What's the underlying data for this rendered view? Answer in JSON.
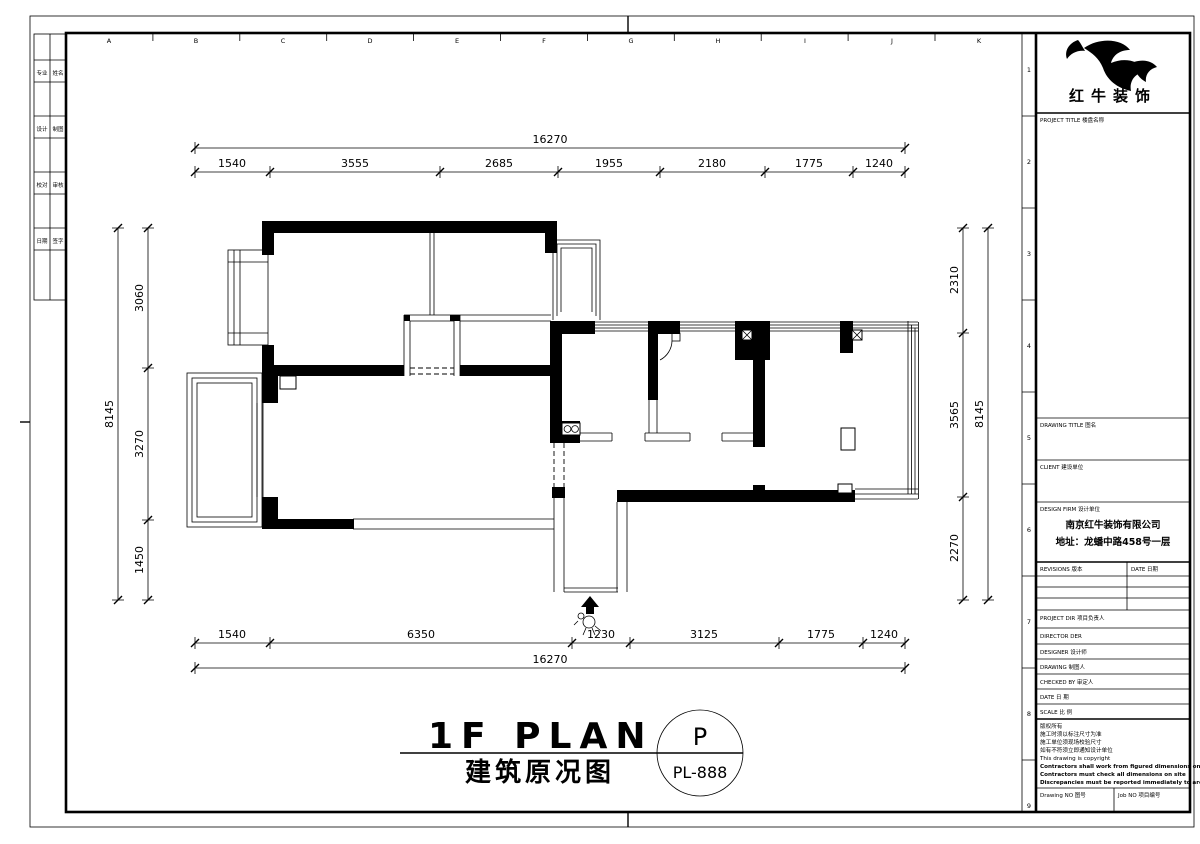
{
  "sheet": {
    "grid_letters": [
      "A",
      "B",
      "C",
      "D",
      "E",
      "F",
      "G",
      "H",
      "I",
      "J",
      "K"
    ],
    "grid_numbers": [
      "1",
      "2",
      "3",
      "4",
      "5",
      "6",
      "7",
      "8",
      "9"
    ],
    "sign_strip": {
      "rows": [
        [
          "专业",
          "姓名"
        ],
        [
          "设计",
          "制图"
        ],
        [
          "校对",
          "审核"
        ],
        [
          "日期",
          "签字"
        ]
      ]
    }
  },
  "plan": {
    "dims_top": {
      "total": "16270",
      "segments": [
        "1540",
        "3555",
        "2685",
        "1955",
        "2180",
        "1775",
        "1240"
      ]
    },
    "dims_bottom": {
      "total": "16270",
      "segments": [
        "1540",
        "6350",
        "1230",
        "3125",
        "1775",
        "1240"
      ]
    },
    "dims_left": {
      "total": "8145",
      "segments": [
        "3060",
        "3270",
        "1450"
      ]
    },
    "dims_right": {
      "total": "8145",
      "segments": [
        "2310",
        "3565",
        "2270"
      ]
    }
  },
  "footer": {
    "main_title": "1F PLAN",
    "sub_title": "建筑原况图",
    "bubble_letter": "P",
    "bubble_code": "PL-888"
  },
  "tb": {
    "brand": "红牛装饰",
    "project_title_label": "PROJECT TITLE  楼盘名称",
    "drawing_title_label": "DRAWING TITLE  图名",
    "client_label": "CLIENT  建设单位",
    "design_firm_label": "DESIGN FIRM  设计单位",
    "firm_name": "南京红牛装饰有限公司",
    "firm_address": "地址：龙蟠中路458号一层",
    "revisions_label": "REVISIONS  版本",
    "date_col_label": "DATE  日期",
    "rows": [
      "PROJECT DIR  项目负责人",
      "DIRECTOR DER",
      "DESIGNER  设计师",
      "DRAWING  制图人",
      "CHECKED BY  审定人",
      "DATE  日 期",
      "SCALE  比 例"
    ],
    "copyright": [
      "版权所有",
      "施工时须以标注尺寸为准",
      "施工单位须现场校验尺寸",
      "如有不符须立即通知设计单位",
      "This drawing is copyright",
      "Contractors shall work from figured dimensions only",
      "Contractors must check all dimensions on site",
      "Discrepancies must be reported immediately to architects"
    ],
    "drawing_no_label": "Drawing NO  图号",
    "job_no_label": "Job NO  项目编号"
  }
}
